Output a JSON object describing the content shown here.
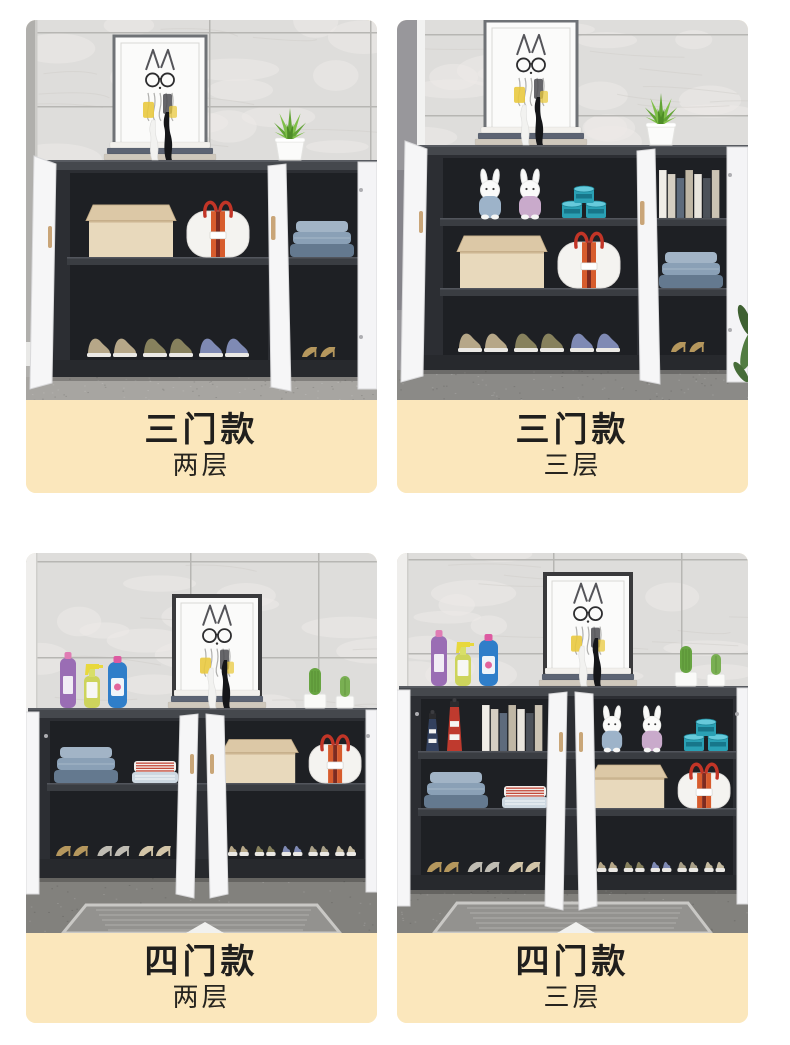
{
  "theme": {
    "page_background": "#ffffff",
    "label_background": "#fbe7bc",
    "label_text": "#201f1d",
    "cabinet_dark": "#2c2e33",
    "door_white": "#f6f6f7",
    "handbag_stripe_red": "#c23527",
    "plant_green": "#7fbf49",
    "tin_teal": "#2aa0b4"
  },
  "cards": [
    {
      "title": "三门款",
      "subtitle": "两层",
      "scene": {
        "doors": 3,
        "layers": 2,
        "environment": [
          "wall-corner-left"
        ],
        "floor": "concrete-light",
        "top_decor": [
          "picture-frame-rabbit-art",
          "book-stack",
          "figurines",
          "succulent-plant"
        ],
        "shelves": [
          {
            "left": [
              "storage-box",
              "striped-handbag"
            ],
            "right": [
              "folded-blue-clothes"
            ]
          }
        ],
        "bottom": {
          "left": "sneakers:3",
          "right": "high-heels:1"
        }
      }
    },
    {
      "title": "三门款",
      "subtitle": "三层",
      "scene": {
        "doors": 3,
        "layers": 3,
        "environment": [
          "window-left",
          "plant-bottom-right"
        ],
        "floor": "carpet-gray",
        "top_decor": [
          "picture-frame-rabbit-art",
          "book-stack",
          "figurines",
          "succulent-plant"
        ],
        "shelves": [
          {
            "left": [
              "plush-bunnies",
              "storage-tins"
            ],
            "right": [
              "book-row"
            ]
          },
          {
            "left": [
              "storage-box",
              "striped-handbag"
            ],
            "right": [
              "folded-blue-clothes"
            ]
          }
        ],
        "bottom": {
          "left": "sneakers:3",
          "right": "high-heels:1"
        }
      }
    },
    {
      "title": "四门款",
      "subtitle": "两层",
      "scene": {
        "doors": 4,
        "layers": 2,
        "environment": [
          "wall-left-light"
        ],
        "floor": "carpet-rug",
        "top_decor": [
          "detergent-bottles",
          "picture-frame-rabbit-art",
          "book-stack",
          "figurines",
          "cactus-plants"
        ],
        "shelves": [
          {
            "left": [
              "folded-blue-clothes",
              "striped-folded-clothes"
            ],
            "right": [
              "storage-box",
              "striped-handbag"
            ]
          }
        ],
        "bottom": {
          "left": "high-heels:3",
          "right": "sneakers:5"
        }
      }
    },
    {
      "title": "四门款",
      "subtitle": "三层",
      "scene": {
        "doors": 4,
        "layers": 3,
        "environment": [
          "wall-left-light"
        ],
        "floor": "carpet-rug",
        "top_decor": [
          "detergent-bottles",
          "picture-frame-rabbit-art",
          "book-stack",
          "figurines",
          "cactus-plants"
        ],
        "shelves": [
          {
            "left": [
              "lighthouse-figurines",
              "book-row"
            ],
            "right": [
              "plush-bunnies",
              "storage-tins"
            ]
          },
          {
            "left": [
              "folded-blue-clothes",
              "striped-folded-clothes"
            ],
            "right": [
              "storage-box",
              "striped-handbag"
            ]
          }
        ],
        "bottom": {
          "left": "high-heels:3",
          "right": "sneakers:5"
        }
      }
    }
  ]
}
